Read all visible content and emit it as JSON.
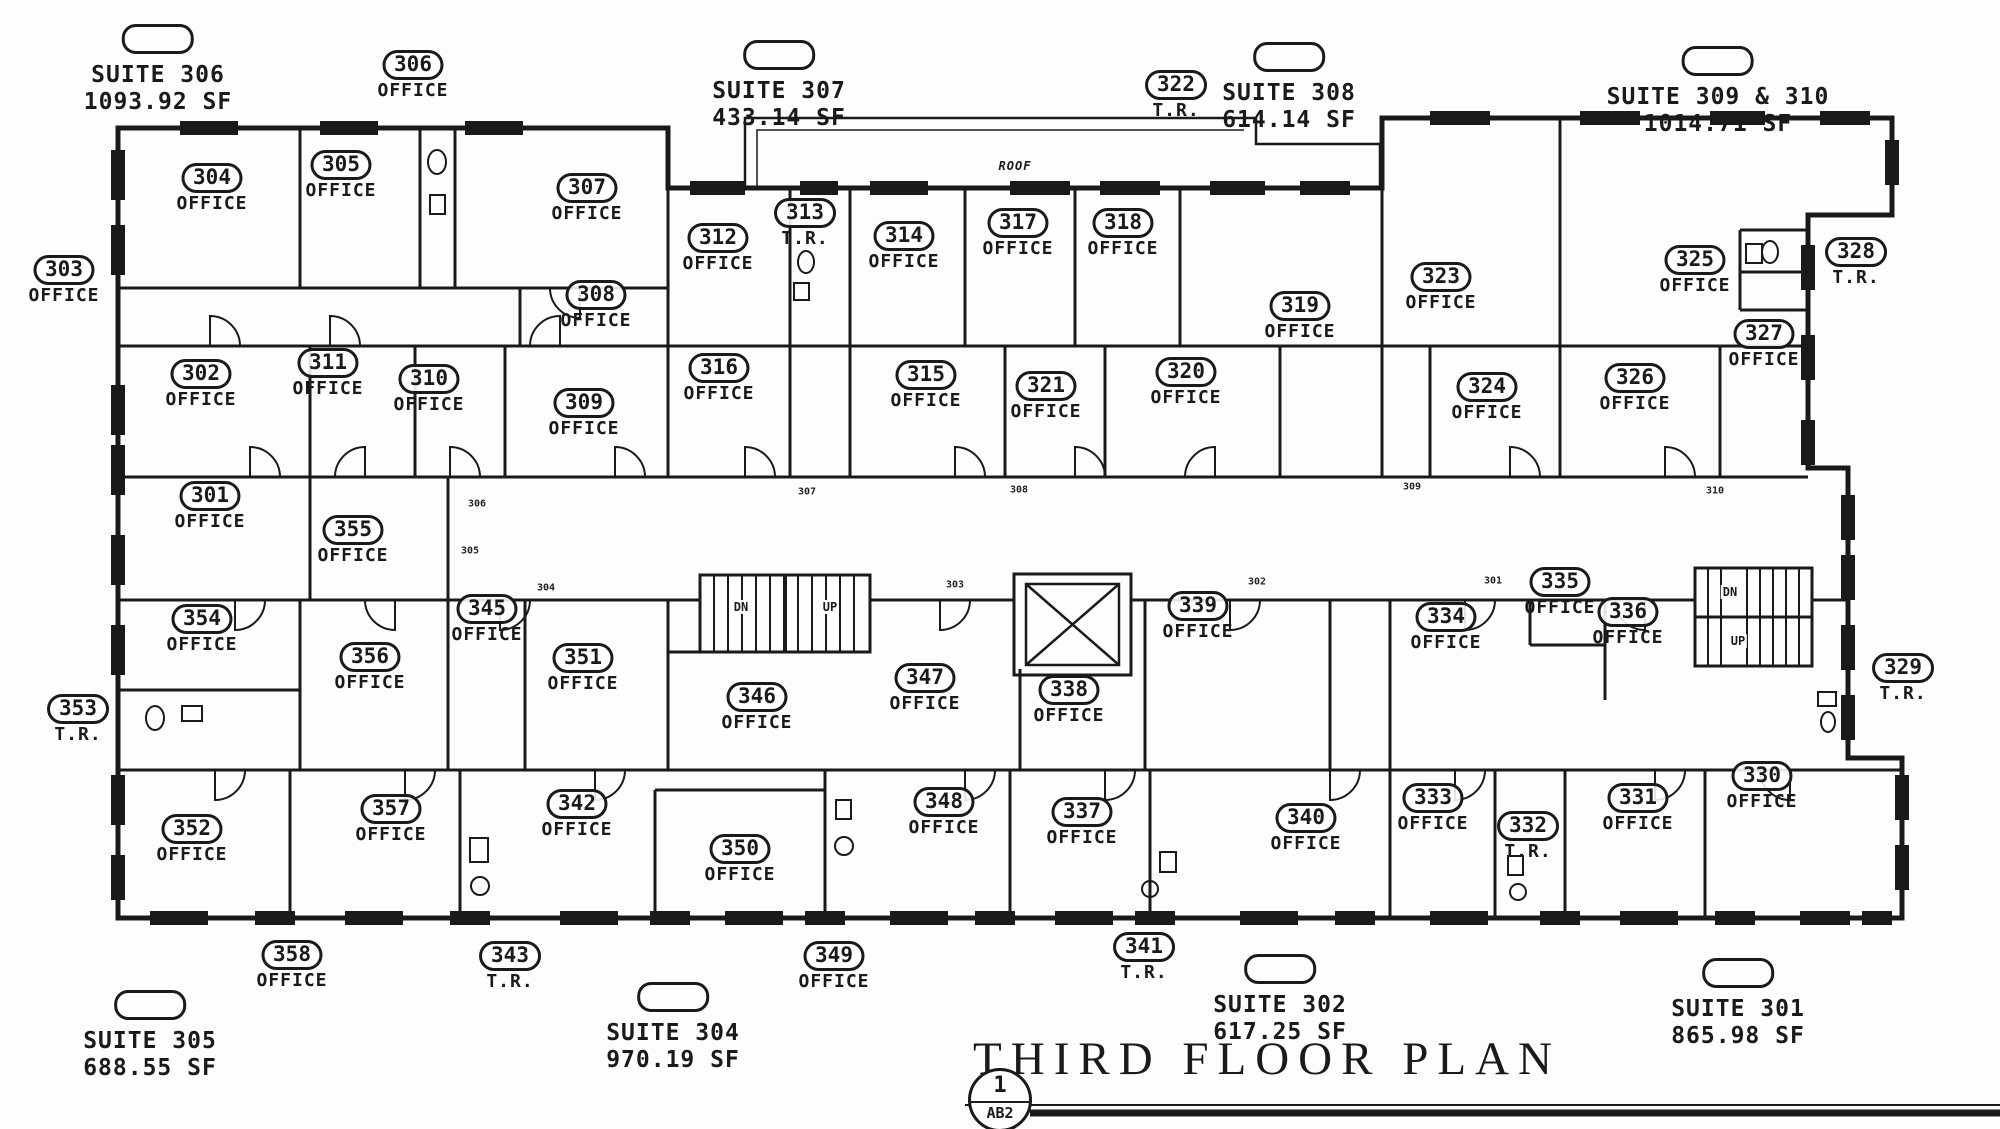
{
  "document": {
    "title": "THIRD FLOOR PLAN",
    "sheet_number": "1",
    "sheet_ref": "AB2",
    "roof_label": "ROOF"
  },
  "suites": [
    {
      "name": "SUITE 306",
      "area": "1093.92 SF",
      "x": 158,
      "y": 24
    },
    {
      "name": "SUITE 307",
      "area": "433.14 SF",
      "x": 779,
      "y": 40
    },
    {
      "name": "SUITE 308",
      "area": "614.14 SF",
      "x": 1289,
      "y": 42
    },
    {
      "name": "SUITE 309 & 310",
      "area": "1014.71 SF",
      "x": 1718,
      "y": 46
    },
    {
      "name": "SUITE 305",
      "area": "688.55 SF",
      "x": 150,
      "y": 990
    },
    {
      "name": "SUITE 304",
      "area": "970.19 SF",
      "x": 673,
      "y": 982
    },
    {
      "name": "SUITE 302",
      "area": "617.25 SF",
      "x": 1280,
      "y": 954
    },
    {
      "name": "SUITE 301",
      "area": "865.98 SF",
      "x": 1738,
      "y": 958
    }
  ],
  "rooms": [
    {
      "id": "304",
      "type": "OFFICE",
      "x": 212,
      "y": 188
    },
    {
      "id": "305",
      "type": "OFFICE",
      "x": 341,
      "y": 175
    },
    {
      "id": "307",
      "type": "OFFICE",
      "x": 587,
      "y": 198
    },
    {
      "id": "308",
      "type": "OFFICE",
      "x": 596,
      "y": 305
    },
    {
      "id": "312",
      "type": "OFFICE",
      "x": 718,
      "y": 248
    },
    {
      "id": "313",
      "type": "T.R.",
      "x": 805,
      "y": 223
    },
    {
      "id": "314",
      "type": "OFFICE",
      "x": 904,
      "y": 246
    },
    {
      "id": "317",
      "type": "OFFICE",
      "x": 1018,
      "y": 233
    },
    {
      "id": "318",
      "type": "OFFICE",
      "x": 1123,
      "y": 233
    },
    {
      "id": "319",
      "type": "OFFICE",
      "x": 1300,
      "y": 316
    },
    {
      "id": "323",
      "type": "OFFICE",
      "x": 1441,
      "y": 287
    },
    {
      "id": "325",
      "type": "OFFICE",
      "x": 1695,
      "y": 270
    },
    {
      "id": "302",
      "type": "OFFICE",
      "x": 201,
      "y": 384
    },
    {
      "id": "311",
      "type": "OFFICE",
      "x": 328,
      "y": 373
    },
    {
      "id": "310",
      "type": "OFFICE",
      "x": 429,
      "y": 389
    },
    {
      "id": "309",
      "type": "OFFICE",
      "x": 584,
      "y": 413
    },
    {
      "id": "316",
      "type": "OFFICE",
      "x": 719,
      "y": 378
    },
    {
      "id": "315",
      "type": "OFFICE",
      "x": 926,
      "y": 385
    },
    {
      "id": "321",
      "type": "OFFICE",
      "x": 1046,
      "y": 396
    },
    {
      "id": "320",
      "type": "OFFICE",
      "x": 1186,
      "y": 382
    },
    {
      "id": "324",
      "type": "OFFICE",
      "x": 1487,
      "y": 397
    },
    {
      "id": "326",
      "type": "OFFICE",
      "x": 1635,
      "y": 388
    },
    {
      "id": "327",
      "type": "OFFICE",
      "x": 1764,
      "y": 344
    },
    {
      "id": "301",
      "type": "OFFICE",
      "x": 210,
      "y": 506
    },
    {
      "id": "355",
      "type": "OFFICE",
      "x": 353,
      "y": 540
    },
    {
      "id": "354",
      "type": "OFFICE",
      "x": 202,
      "y": 629
    },
    {
      "id": "356",
      "type": "OFFICE",
      "x": 370,
      "y": 667
    },
    {
      "id": "345",
      "type": "OFFICE",
      "x": 487,
      "y": 619
    },
    {
      "id": "351",
      "type": "OFFICE",
      "x": 583,
      "y": 668
    },
    {
      "id": "346",
      "type": "OFFICE",
      "x": 757,
      "y": 707
    },
    {
      "id": "347",
      "type": "OFFICE",
      "x": 925,
      "y": 688
    },
    {
      "id": "339",
      "type": "OFFICE",
      "x": 1198,
      "y": 616
    },
    {
      "id": "338",
      "type": "OFFICE",
      "x": 1069,
      "y": 700
    },
    {
      "id": "334",
      "type": "OFFICE",
      "x": 1446,
      "y": 627
    },
    {
      "id": "335",
      "type": "OFFICE",
      "x": 1560,
      "y": 592
    },
    {
      "id": "336",
      "type": "OFFICE",
      "x": 1628,
      "y": 622
    },
    {
      "id": "352",
      "type": "OFFICE",
      "x": 192,
      "y": 839
    },
    {
      "id": "357",
      "type": "OFFICE",
      "x": 391,
      "y": 819
    },
    {
      "id": "342",
      "type": "OFFICE",
      "x": 577,
      "y": 814
    },
    {
      "id": "350",
      "type": "OFFICE",
      "x": 740,
      "y": 859
    },
    {
      "id": "348",
      "type": "OFFICE",
      "x": 944,
      "y": 812
    },
    {
      "id": "337",
      "type": "OFFICE",
      "x": 1082,
      "y": 822
    },
    {
      "id": "340",
      "type": "OFFICE",
      "x": 1306,
      "y": 828
    },
    {
      "id": "333",
      "type": "OFFICE",
      "x": 1433,
      "y": 808
    },
    {
      "id": "332",
      "type": "T.R.",
      "x": 1528,
      "y": 836
    },
    {
      "id": "331",
      "type": "OFFICE",
      "x": 1638,
      "y": 808
    },
    {
      "id": "330",
      "type": "OFFICE",
      "x": 1762,
      "y": 786
    }
  ],
  "exterior_rooms": [
    {
      "id": "306",
      "type": "OFFICE",
      "x": 413,
      "y": 75
    },
    {
      "id": "322",
      "type": "T.R.",
      "x": 1176,
      "y": 95
    },
    {
      "id": "303",
      "type": "OFFICE",
      "x": 64,
      "y": 280
    },
    {
      "id": "353",
      "type": "T.R.",
      "x": 78,
      "y": 719
    },
    {
      "id": "328",
      "type": "T.R.",
      "x": 1856,
      "y": 262
    },
    {
      "id": "329",
      "type": "T.R.",
      "x": 1903,
      "y": 678
    },
    {
      "id": "358",
      "type": "OFFICE",
      "x": 292,
      "y": 965
    },
    {
      "id": "343",
      "type": "T.R.",
      "x": 510,
      "y": 966
    },
    {
      "id": "349",
      "type": "OFFICE",
      "x": 834,
      "y": 966
    },
    {
      "id": "341",
      "type": "T.R.",
      "x": 1144,
      "y": 957
    }
  ],
  "corridor_tags": [
    {
      "t": "306",
      "x": 477,
      "y": 504
    },
    {
      "t": "307",
      "x": 807,
      "y": 492
    },
    {
      "t": "308",
      "x": 1019,
      "y": 490
    },
    {
      "t": "309",
      "x": 1412,
      "y": 487
    },
    {
      "t": "310",
      "x": 1715,
      "y": 491
    },
    {
      "t": "305",
      "x": 470,
      "y": 551
    },
    {
      "t": "304",
      "x": 546,
      "y": 588
    },
    {
      "t": "303",
      "x": 955,
      "y": 585
    },
    {
      "t": "302",
      "x": 1257,
      "y": 582
    },
    {
      "t": "301",
      "x": 1493,
      "y": 581
    }
  ],
  "stair_labels": [
    {
      "text": "DN",
      "x": 741,
      "y": 607
    },
    {
      "text": "UP",
      "x": 830,
      "y": 607
    },
    {
      "text": "DN",
      "x": 1730,
      "y": 592
    },
    {
      "text": "UP",
      "x": 1738,
      "y": 641
    }
  ]
}
